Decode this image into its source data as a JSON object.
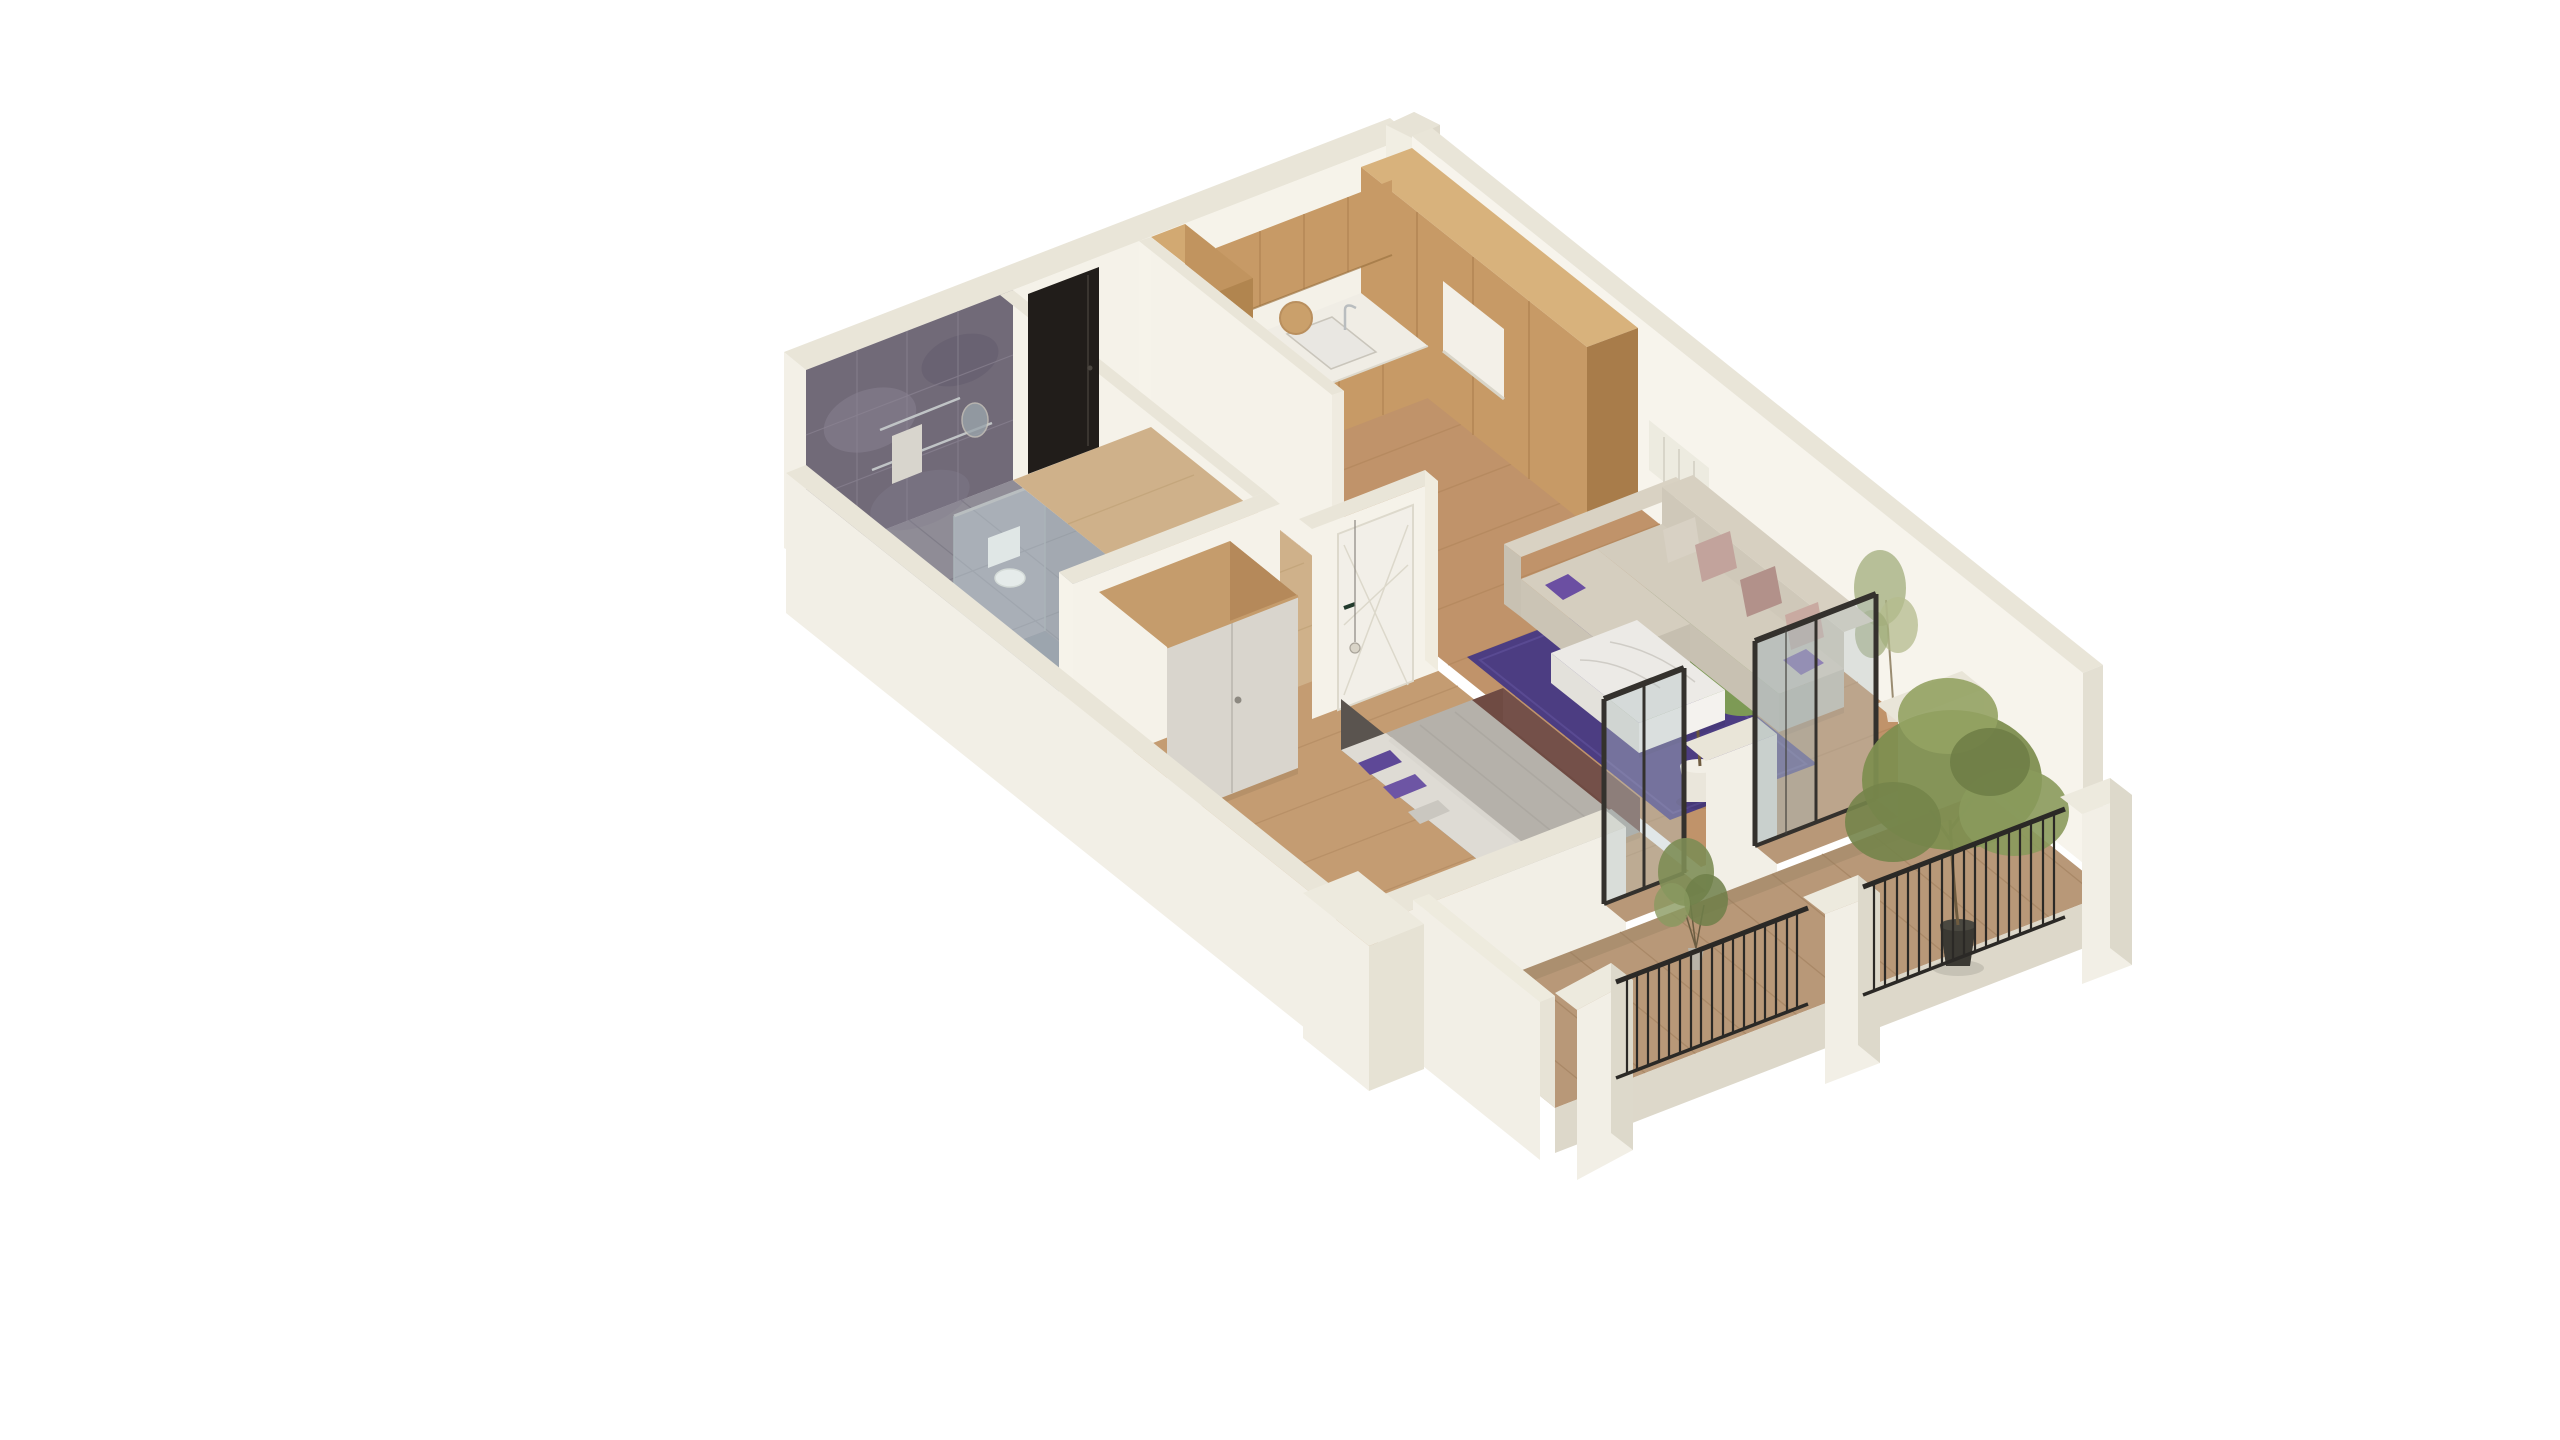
{
  "scene": {
    "type": "isometric-apartment-floorplan-render",
    "description": "3D cutaway isometric rendering of a one-bedroom apartment with balcony",
    "rooms": [
      {
        "id": "bathroom",
        "name": "bathroom"
      },
      {
        "id": "hallway",
        "name": "entrance hallway"
      },
      {
        "id": "kitchen",
        "name": "kitchen"
      },
      {
        "id": "living-room",
        "name": "living room"
      },
      {
        "id": "bedroom",
        "name": "bedroom"
      },
      {
        "id": "balcony",
        "name": "balcony"
      }
    ],
    "furniture": [
      "kitchen-cabinets-l-shape",
      "cooktop",
      "sink",
      "tall-units",
      "corner-sofa",
      "purple-rug",
      "marble-coffee-table",
      "radiator",
      "double-bed",
      "wardrobe",
      "pendant-lamp",
      "toilet",
      "glass-shower",
      "towel-rail",
      "mirror",
      "entrance-door-black",
      "bedroom-door-white",
      "glass-door-bedroom",
      "glass-door-living",
      "balcony-railings",
      "parapet-pillars"
    ],
    "plants": [
      "indoor-bushy-plant",
      "indoor-slim-plant",
      "balcony-small-plant",
      "balcony-tree"
    ]
  },
  "palette": {
    "bg": "#ffffff",
    "wallTop": "#e9e5d8",
    "wallFace": "#f5f2e9",
    "wallFaceShade": "#e7e3d6",
    "wallOuter": "#f2efe6",
    "wallOuterShade": "#ddd8ca",
    "tileDark": "#716a78",
    "bathFloor": "#8f8c96",
    "showerTint": "#a9bec6",
    "woodFloorKitchen": "#c0936a",
    "woodFloorHall": "#cfb18a",
    "woodFloorBedroom": "#c49c72",
    "balconyFloor": "#b89878",
    "cabinetWood": "#c79a66",
    "cabinetWoodDark": "#a87c4a",
    "cabinetWoodTop": "#d8b27c",
    "counter": "#f0ede5",
    "cooktop": "#1c1b1a",
    "glass": "#b5c3c6",
    "frameBlack": "#34312d",
    "doorBlack": "#211d1a",
    "doorWhite": "#f2efe8",
    "wardrobeDoor": "#d9d5cd",
    "wardrobeWood": "#b5895a",
    "bedDuvet": "#b5b1aa",
    "bedSheet": "#dedbd4",
    "bedBlanket": "#6f4b43",
    "headboard": "#5a544f",
    "pillowPurple": "#5e4897",
    "sofaBody": "#d3ccbd",
    "sofaShade": "#c4bdae",
    "cushionMauve": "#b2918a",
    "rugPurple": "#4c3d82",
    "tableMarble": "#eceae6",
    "railing": "#2b2926",
    "foliage": "#7d8d55",
    "foliageDark": "#6e7f49",
    "foliageLight": "#93a263",
    "potWhite": "#eae6db",
    "potDark": "#3b3933",
    "trunk": "#6f5c40"
  }
}
